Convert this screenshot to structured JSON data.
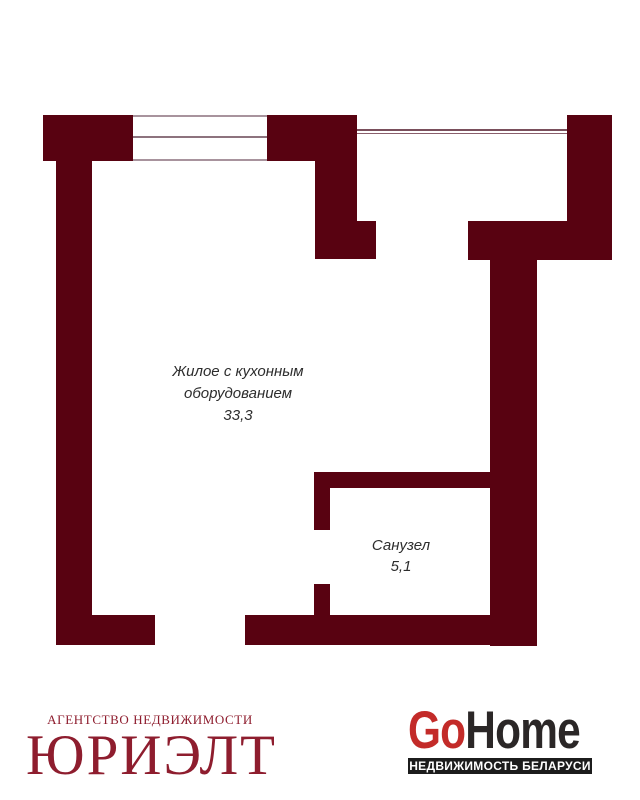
{
  "plan": {
    "main_room": {
      "label_line1": "Жилое с кухонным",
      "label_line2": "оборудованием",
      "area": "33,3"
    },
    "bathroom": {
      "label": "Санузел",
      "area": "5,1"
    }
  },
  "branding": {
    "agency": {
      "tagline": "АГЕНТСТВО НЕДВИЖИМОСТИ",
      "name": "ЮРИЭЛТ",
      "color": "#8e1d2e"
    },
    "gohome": {
      "prefix": "Go",
      "suffix": "Home",
      "tagline": "НЕДВИЖИМОСТЬ БЕЛАРУСИ",
      "accent_color": "#c32b29",
      "text_color": "#2b2727",
      "bar_background": "#1c1c1c"
    }
  },
  "colors": {
    "wall": "#580211",
    "window_frame": "#a8939d",
    "window_mid_line": "#8d737e",
    "balcony_line": "#7a4f5c",
    "room_text": "#2d2d2d",
    "background": "#ffffff"
  }
}
